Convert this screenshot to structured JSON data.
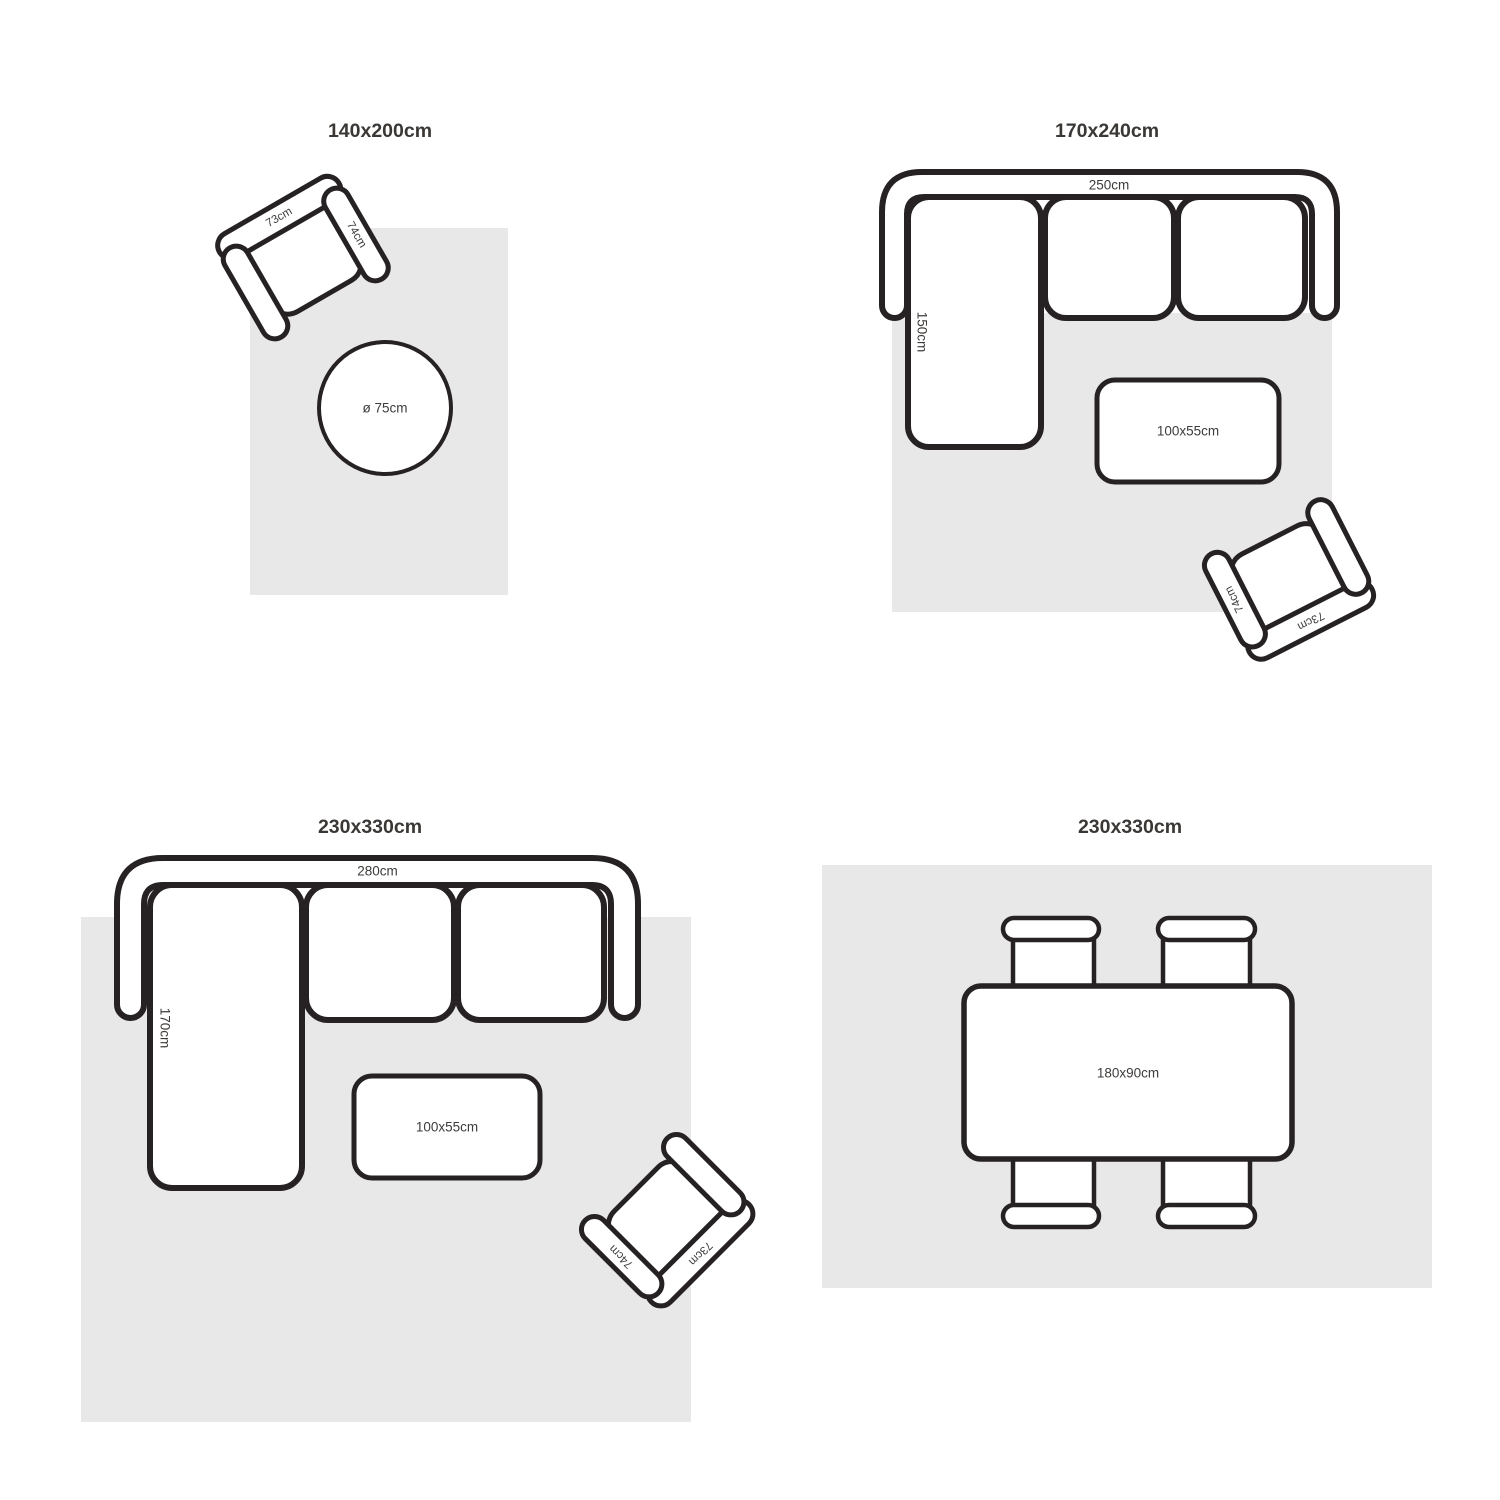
{
  "figure": {
    "name": "rug-size-guide",
    "description": "Four top-view furniture layout diagrams showing rug sizes"
  },
  "colors": {
    "background": "#ffffff",
    "rug": "#e9e8e8",
    "furniture": "#ffffff",
    "outline": "#262122",
    "label": "#3e3b39",
    "title": "#3a3735"
  },
  "panels": [
    {
      "title": "140x200cm",
      "armchair": {
        "back": "73cm",
        "arm": "74cm"
      },
      "round_table": "ø 75cm"
    },
    {
      "title": "170x240cm",
      "sofa": {
        "width": "250cm",
        "depth": "150cm"
      },
      "coffee_table": "100x55cm",
      "armchair": {
        "back": "73cm",
        "arm": "74cm"
      }
    },
    {
      "title": "230x330cm",
      "sofa": {
        "width": "280cm",
        "depth": "170cm"
      },
      "coffee_table": "100x55cm",
      "armchair": {
        "back": "73cm",
        "arm": "74cm"
      }
    },
    {
      "title": "230x330cm",
      "dining_table": "180x90cm"
    }
  ]
}
